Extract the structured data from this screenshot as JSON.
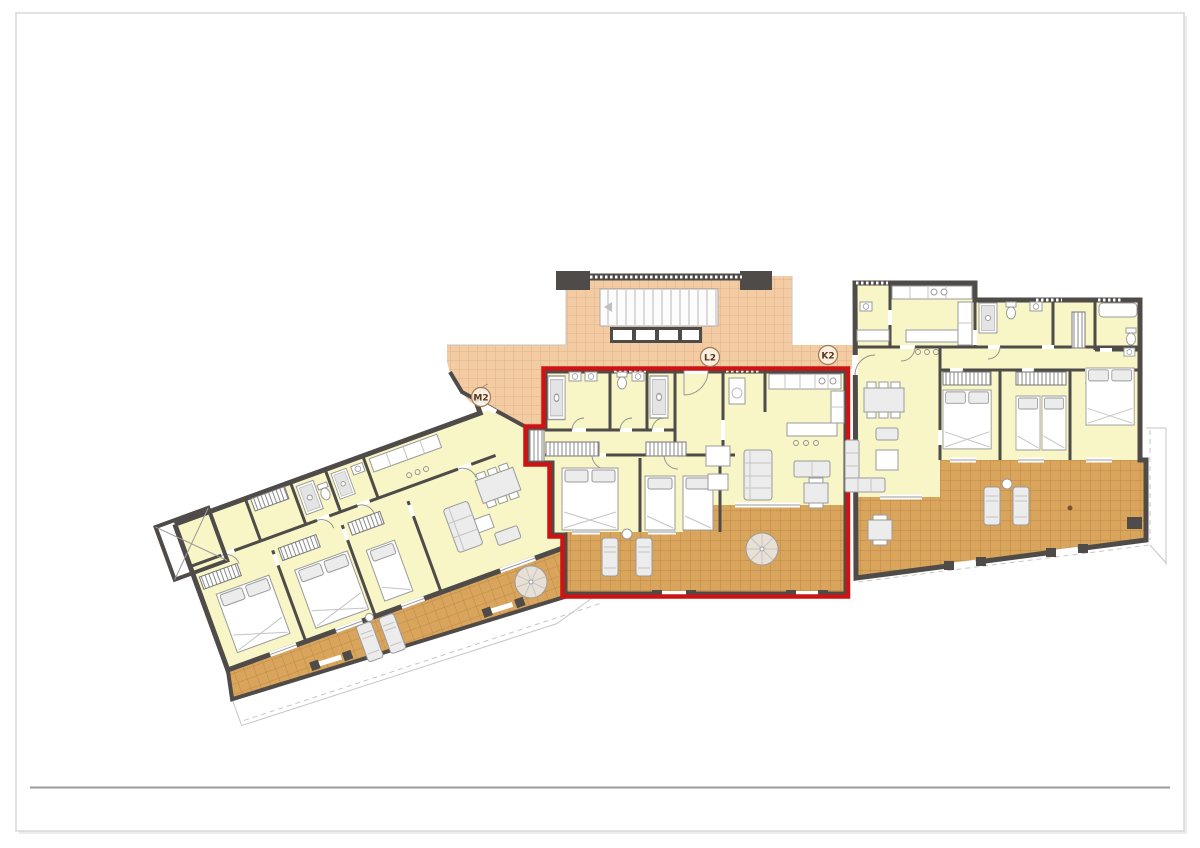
{
  "document": {
    "type": "architectural-floor-plan",
    "description": "Upper floor plan of a terraced apartment building with three units; the middle apartment is highlighted with a red outline.",
    "labels": {
      "m2": "M2",
      "l2": "L2",
      "k2": "K2"
    },
    "units": {
      "left": {
        "name": "left-apartment",
        "label": "M2",
        "rotation_deg": -20,
        "highlighted": false
      },
      "center": {
        "name": "center-apartment",
        "label": "L2",
        "rotation_deg": 0,
        "highlighted": true
      },
      "right": {
        "name": "right-apartment",
        "label": "K2",
        "rotation_deg": 0,
        "highlighted": false
      }
    },
    "palette": {
      "room_fill": "#f8f5c6",
      "wall": "#4e4b49",
      "terrace_tile": "#d9a45c",
      "terrace_grid": "#bd8946",
      "landing_tile": "#f4cca4",
      "landing_grid": "#e0b286",
      "furniture_fill": "#ececec",
      "furniture_stroke": "#9a9a9a",
      "highlight": "#cc1414",
      "sheet_border": "#d8d8d8",
      "footer_rule": "#9b9b9b"
    }
  }
}
